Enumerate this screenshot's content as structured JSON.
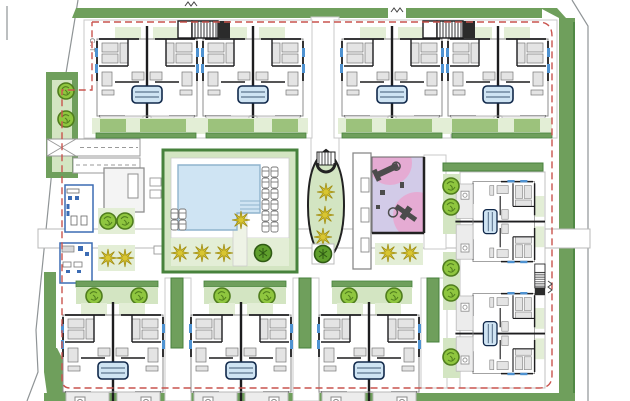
{
  "labels": {
    "transformer_station": "C.T"
  },
  "icons": {
    "tree": "round-canopy-tree",
    "bush": "shrub",
    "palm": "yellow-starburst-palm",
    "lounger": "sun-lounger",
    "stair_core": "striped-stair-core",
    "gate_marker": "zigzag-gate-mark",
    "plunge_pool": "blue-striped-plunge-pool",
    "play_equipment": "dark-playground-equipment"
  },
  "colors": {
    "paper": "#ffffff",
    "outline": "#8f9496",
    "wall": "#1d1d1f",
    "wall_soft": "#8c8c8c",
    "deck": "#ececec",
    "deck_line": "#b9b9b9",
    "green_band": "#6f9f5c",
    "green_dark": "#47823c",
    "green_light": "#d3e5c2",
    "green_pale": "#e3eed6",
    "garden_mid": "#9cc27c",
    "tree": "#8fc63f",
    "tree_dark": "#4f7d1d",
    "bush": "#5f9f2c",
    "palm": "#d8c531",
    "palm_dark": "#a28f14",
    "pool": "#cfe4f3",
    "pool_edge": "#8fb3cd",
    "unit_blue": "#4f93d2",
    "club_blue": "#3c6cb4",
    "pink": "#e5abd3",
    "lavender": "#d2cbe8",
    "equipment": "#4c4c4c",
    "red_dash": "#c9544e",
    "label": "#707070"
  }
}
